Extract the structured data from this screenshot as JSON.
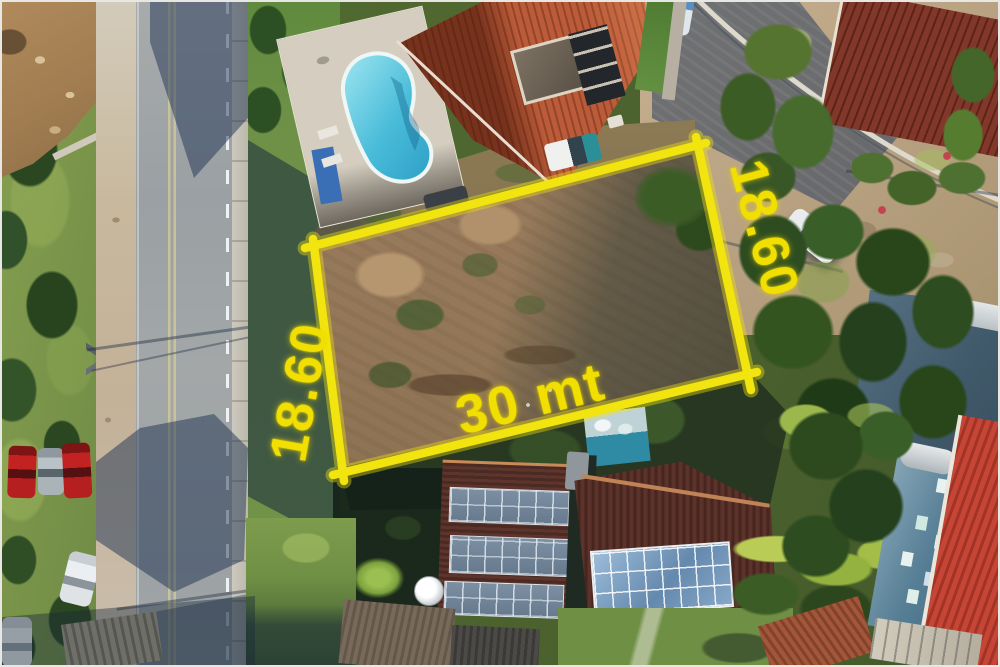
{
  "annotation": {
    "left_side_label": "18.60",
    "right_side_label": "18.60",
    "bottom_side_label": "30 mt",
    "outline_color": "#f2e40e",
    "label_color": "#f0df00"
  },
  "palette": {
    "annotation_yellow": "#f2e40e",
    "pool_water": "#49bcd9",
    "roof_terracotta": "#bc5b39",
    "dark_roof_brown": "#4a2a22",
    "asphalt_gray": "#9ca1a4",
    "shadow_blue": "#2e4866",
    "grass_green": "#7a954a",
    "lot_dirt_brown": "#8f7457",
    "solar_panel_blue": "#6589ad",
    "bright_red_roof": "#c64636",
    "blue_building_wall": "#567e95"
  }
}
